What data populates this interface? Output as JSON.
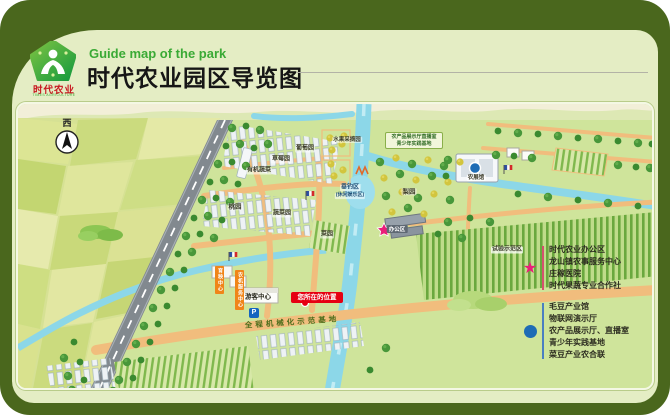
{
  "header": {
    "subtitle_en": "Guide map of the park",
    "title_cn": "时代农业园区导览图",
    "logo": {
      "brand_cn": "时代农业",
      "brand_en": "TIMES AGRICULTURE"
    }
  },
  "map": {
    "compass": "西",
    "areas": {
      "fruit_picking": "水果采摘园",
      "grape": "葡萄园",
      "strawberry": "草莓园",
      "organic_veg": "有机蔬菜",
      "peach": "桃园",
      "fishing_1": "垂钓区",
      "fishing_2": "(休闲娱乐区)",
      "veg_patch": "蔬菜园",
      "veg_garden": "菜园",
      "pear": "梨园",
      "agri_hall": "农展馆",
      "office": "办公区",
      "trial_zone": "试验示范区",
      "visitor_center": "游客中心",
      "mech_base": "全程机械化示范基地",
      "display_line1": "农产品展示厅直播室",
      "display_line2": "青少年实践基地",
      "sign_seedling": "育秧中心",
      "sign_machinery": "农机服务中心",
      "parking": "P"
    },
    "you_are_here": "您所在的位置"
  },
  "legend": {
    "star_items": [
      "时代农业办公区",
      "龙山镇农事服务中心",
      "庄稼医院",
      "时代果蔬专业合作社"
    ],
    "circle_items": [
      "毛豆产业馆",
      "物联网演示厅",
      "农产品展示厅、直播室",
      "青少年实践基地",
      "菜豆产业农合联"
    ]
  },
  "colors": {
    "star_marker": "#ea1e79",
    "circle_marker": "#1e6cb5",
    "badge_red": "#e60012",
    "brand_green": "#3aaa35",
    "frame_green": "#4a671d"
  }
}
